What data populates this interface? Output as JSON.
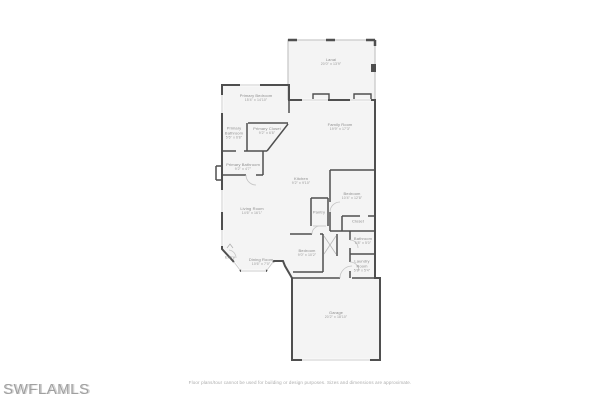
{
  "watermark": "SWFLAMLS",
  "footer": {
    "disclaimer": "Floor plans/tour cannot be used for building or design purposes. Sizes and dimensions are approximate."
  },
  "colors": {
    "wall_dark": "#4f4f4f",
    "wall_light": "#c9c9c9",
    "room_fill": "#f4f4f4",
    "background": "#ffffff",
    "label_text": "#8c8c8c"
  },
  "rooms": [
    {
      "name": "Lanai",
      "dims": "20'0\" x 13'9\""
    },
    {
      "name": "Primary Bedroom",
      "dims": "15'4\" x 14'10\""
    },
    {
      "name": "Primary Bathroom",
      "dims": "5'6\" x 6'8\""
    },
    {
      "name": "Primary Closet",
      "dims": "9'2\" x 6'8\""
    },
    {
      "name": "Primary Bathroom",
      "dims": "9'2\" x 4'7\""
    },
    {
      "name": "Family Room",
      "dims": "19'9\" x 17'3\""
    },
    {
      "name": "Kitchen",
      "dims": "9'2\" x 9'10\""
    },
    {
      "name": "Bedroom",
      "dims": "10'4\" x 12'8\""
    },
    {
      "name": "Pantry",
      "dims": ""
    },
    {
      "name": "Closet",
      "dims": ""
    },
    {
      "name": "Living Room",
      "dims": "14'6\" x 16'1\""
    },
    {
      "name": "Bedroom",
      "dims": "9'0\" x 10'2\""
    },
    {
      "name": "Bathroom",
      "dims": "5'8\" x 5'0\""
    },
    {
      "name": "Laundry Room",
      "dims": "5'8\" x 5'4\""
    },
    {
      "name": "Entry",
      "dims": ""
    },
    {
      "name": "Dining Room",
      "dims": "10'6\" x 7'0\""
    },
    {
      "name": "Garage",
      "dims": "20'2\" x 18'10\""
    }
  ]
}
